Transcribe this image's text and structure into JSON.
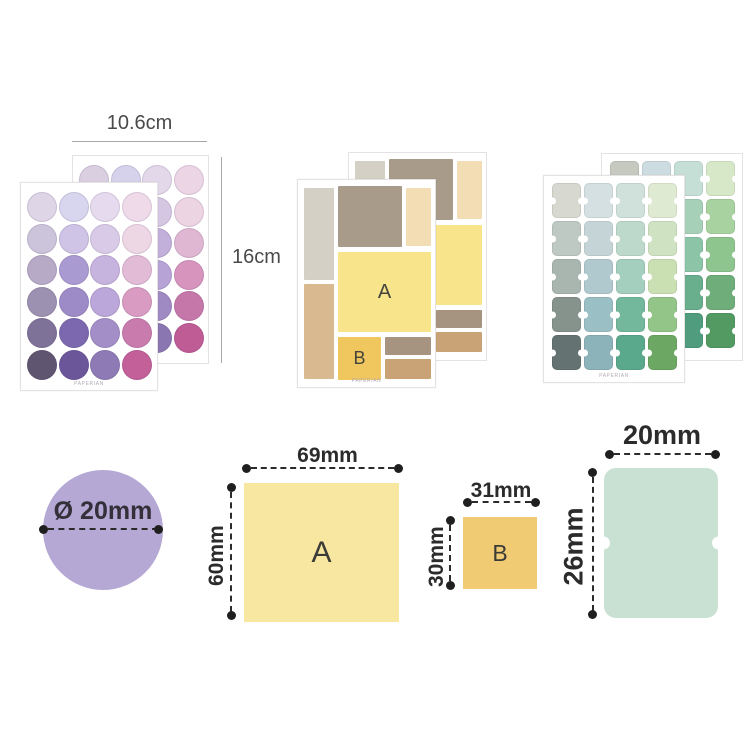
{
  "brand": "PAPERIAN",
  "dimensions_top": {
    "width_label": "10.6cm",
    "height_label": "16cm"
  },
  "sheets": {
    "purple_front": [
      [
        "#ded5e6",
        "#d8d5ef",
        "#e6dbee",
        "#eedae9"
      ],
      [
        "#ccc4da",
        "#cfc3e6",
        "#d9cbe8",
        "#eed7e5"
      ],
      [
        "#b6aac7",
        "#a99ad1",
        "#c6b3de",
        "#e2bbd6"
      ],
      [
        "#9c91b0",
        "#9d8bc8",
        "#bba7d9",
        "#da9bc2"
      ],
      [
        "#7f7299",
        "#7b68af",
        "#a38ec8",
        "#ca7bad"
      ],
      [
        "#605571",
        "#6b569a",
        "#8e7bb6",
        "#c35f99"
      ]
    ],
    "purple_back": [
      [
        "#d9cfe1",
        "#d6d2ec",
        "#e3d8ea",
        "#ecd6e6"
      ],
      [
        "#c8c0d6",
        "#cabfe1",
        "#d5c7e4",
        "#ecd4e2"
      ],
      [
        "#b2a6c3",
        "#a496cd",
        "#c2afda",
        "#dfb7d2"
      ],
      [
        "#988dab",
        "#9987c4",
        "#b7a3d5",
        "#d795be"
      ],
      [
        "#7b6e95",
        "#7764ab",
        "#9f8ac4",
        "#c677a9"
      ],
      [
        "#5c516d",
        "#675295",
        "#8a77b2",
        "#bf5b95"
      ]
    ],
    "mosaic": {
      "label_a": "A",
      "label_b": "B",
      "palette": {
        "lgray": "#d5d0c5",
        "tan": "#d9b98f",
        "taupe": "#a99b89",
        "cream": "#f2ddb5",
        "yellow": "#f7e48b",
        "gold": "#f0c75e",
        "taupe_small": "#a79480",
        "tan_small": "#c9a376"
      }
    },
    "green_front": [
      [
        "#d7d9d0",
        "#d4e0e2",
        "#cfe1da",
        "#dfead2"
      ],
      [
        "#bfc9c3",
        "#c5d5d7",
        "#bdd9cc",
        "#cfe3c2"
      ],
      [
        "#a9b6b0",
        "#b0c9ce",
        "#a4cebd",
        "#cbe0b2"
      ],
      [
        "#85938c",
        "#9abfc4",
        "#73b79c",
        "#93c588"
      ],
      [
        "#647372",
        "#8db3ba",
        "#5ba98c",
        "#6ca864"
      ]
    ],
    "green_back": [
      [
        "#c6c9bf",
        "#cddce0",
        "#c5ded6",
        "#d7e8c8"
      ],
      [
        "#b0bab2",
        "#b7cdd2",
        "#a7d0b9",
        "#a8d2a0"
      ],
      [
        "#99a79f",
        "#9fc2c9",
        "#8bc4a6",
        "#8ec48e"
      ],
      [
        "#7b8b82",
        "#88b1b9",
        "#69ae8d",
        "#6fae7a"
      ],
      [
        "#5a6a69",
        "#7aa5ae",
        "#4f9d7e",
        "#529a62"
      ]
    ]
  },
  "specs": {
    "circle": {
      "label": "Ø 20mm",
      "color": "#b5a8d5"
    },
    "a": {
      "label": "A",
      "width": "69mm",
      "height": "60mm",
      "color": "#f8e7a0"
    },
    "b": {
      "label": "B",
      "width": "31mm",
      "height": "30mm",
      "color": "#f0cb74"
    },
    "tab": {
      "width": "20mm",
      "height": "26mm",
      "color": "#c8e1d3"
    }
  }
}
